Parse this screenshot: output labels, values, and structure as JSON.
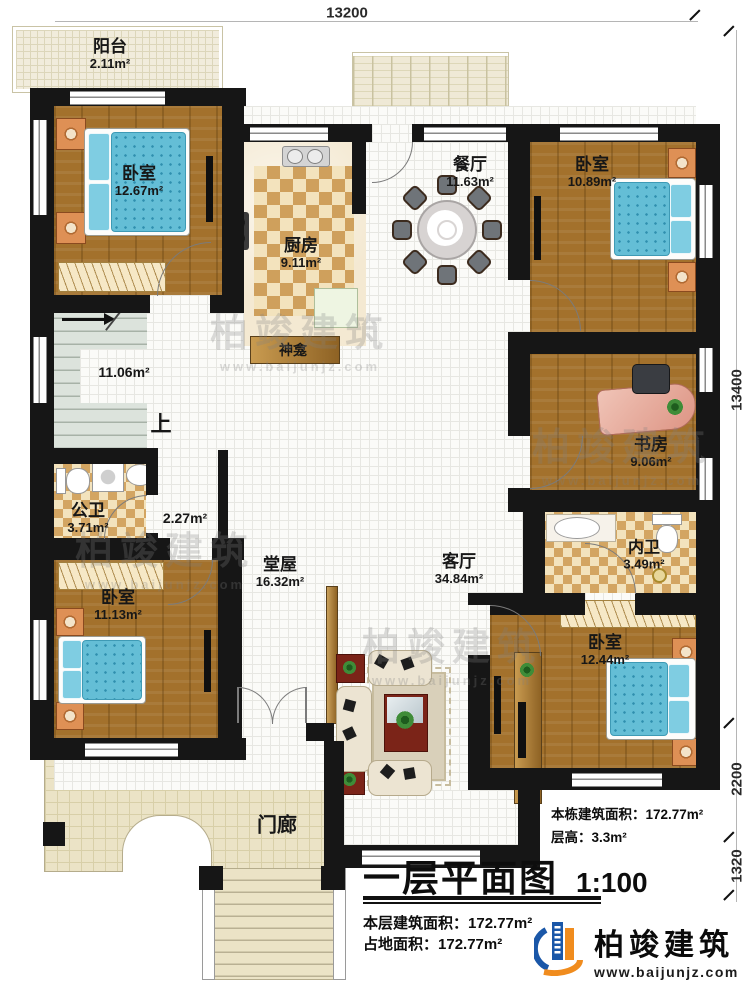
{
  "plan": {
    "title": "一层平面图",
    "scale": "1:100"
  },
  "dimensions": {
    "top": "13200",
    "right_upper": "13400",
    "right_middle": "2200",
    "right_lower": "1320"
  },
  "rooms": [
    {
      "id": "balcony",
      "name": "阳台",
      "area": "2.11m²"
    },
    {
      "id": "bedroom-tl",
      "name": "卧室",
      "area": "12.67m²"
    },
    {
      "id": "kitchen",
      "name": "厨房",
      "area": "9.11m²"
    },
    {
      "id": "dining",
      "name": "餐厅",
      "area": "11.63m²"
    },
    {
      "id": "bedroom-tr",
      "name": "卧室",
      "area": "10.89m²"
    },
    {
      "id": "stair-hall",
      "name": "",
      "area": "11.06m²"
    },
    {
      "id": "shrine",
      "name": "神龛",
      "area": ""
    },
    {
      "id": "public-bath",
      "name": "公卫",
      "area": "3.71m²"
    },
    {
      "id": "corridor",
      "name": "",
      "area": "2.27m²"
    },
    {
      "id": "hall",
      "name": "堂屋",
      "area": "16.32m²"
    },
    {
      "id": "living",
      "name": "客厅",
      "area": "34.84m²"
    },
    {
      "id": "study",
      "name": "书房",
      "area": "9.06m²"
    },
    {
      "id": "inner-bath",
      "name": "内卫",
      "area": "3.49m²"
    },
    {
      "id": "bedroom-bl",
      "name": "卧室",
      "area": "11.13m²"
    },
    {
      "id": "bedroom-br",
      "name": "卧室",
      "area": "12.44m²"
    },
    {
      "id": "porch",
      "name": "门廊",
      "area": ""
    }
  ],
  "stairs": {
    "up_label": "上"
  },
  "annotations": {
    "building_area_label": "本栋建筑面积：",
    "building_area_value": "172.77m²",
    "floor_height_label": "层高：",
    "floor_height_value": "3.3m²"
  },
  "titleblock": {
    "title": "一层平面图",
    "scale": "1:100",
    "floor_area_label": "本层建筑面积：",
    "floor_area_value": "172.77m²",
    "footprint_label": "占地面积：",
    "footprint_value": "172.77m²"
  },
  "brand": {
    "name": "柏竣建筑",
    "url": "www.baijunjz.com"
  },
  "watermark": {
    "name": "柏竣建筑",
    "url": "www.baijunjz.com"
  },
  "colors": {
    "brand_blue": "#1a57a8",
    "brand_orange": "#f08c1e",
    "wall": "#161616"
  }
}
